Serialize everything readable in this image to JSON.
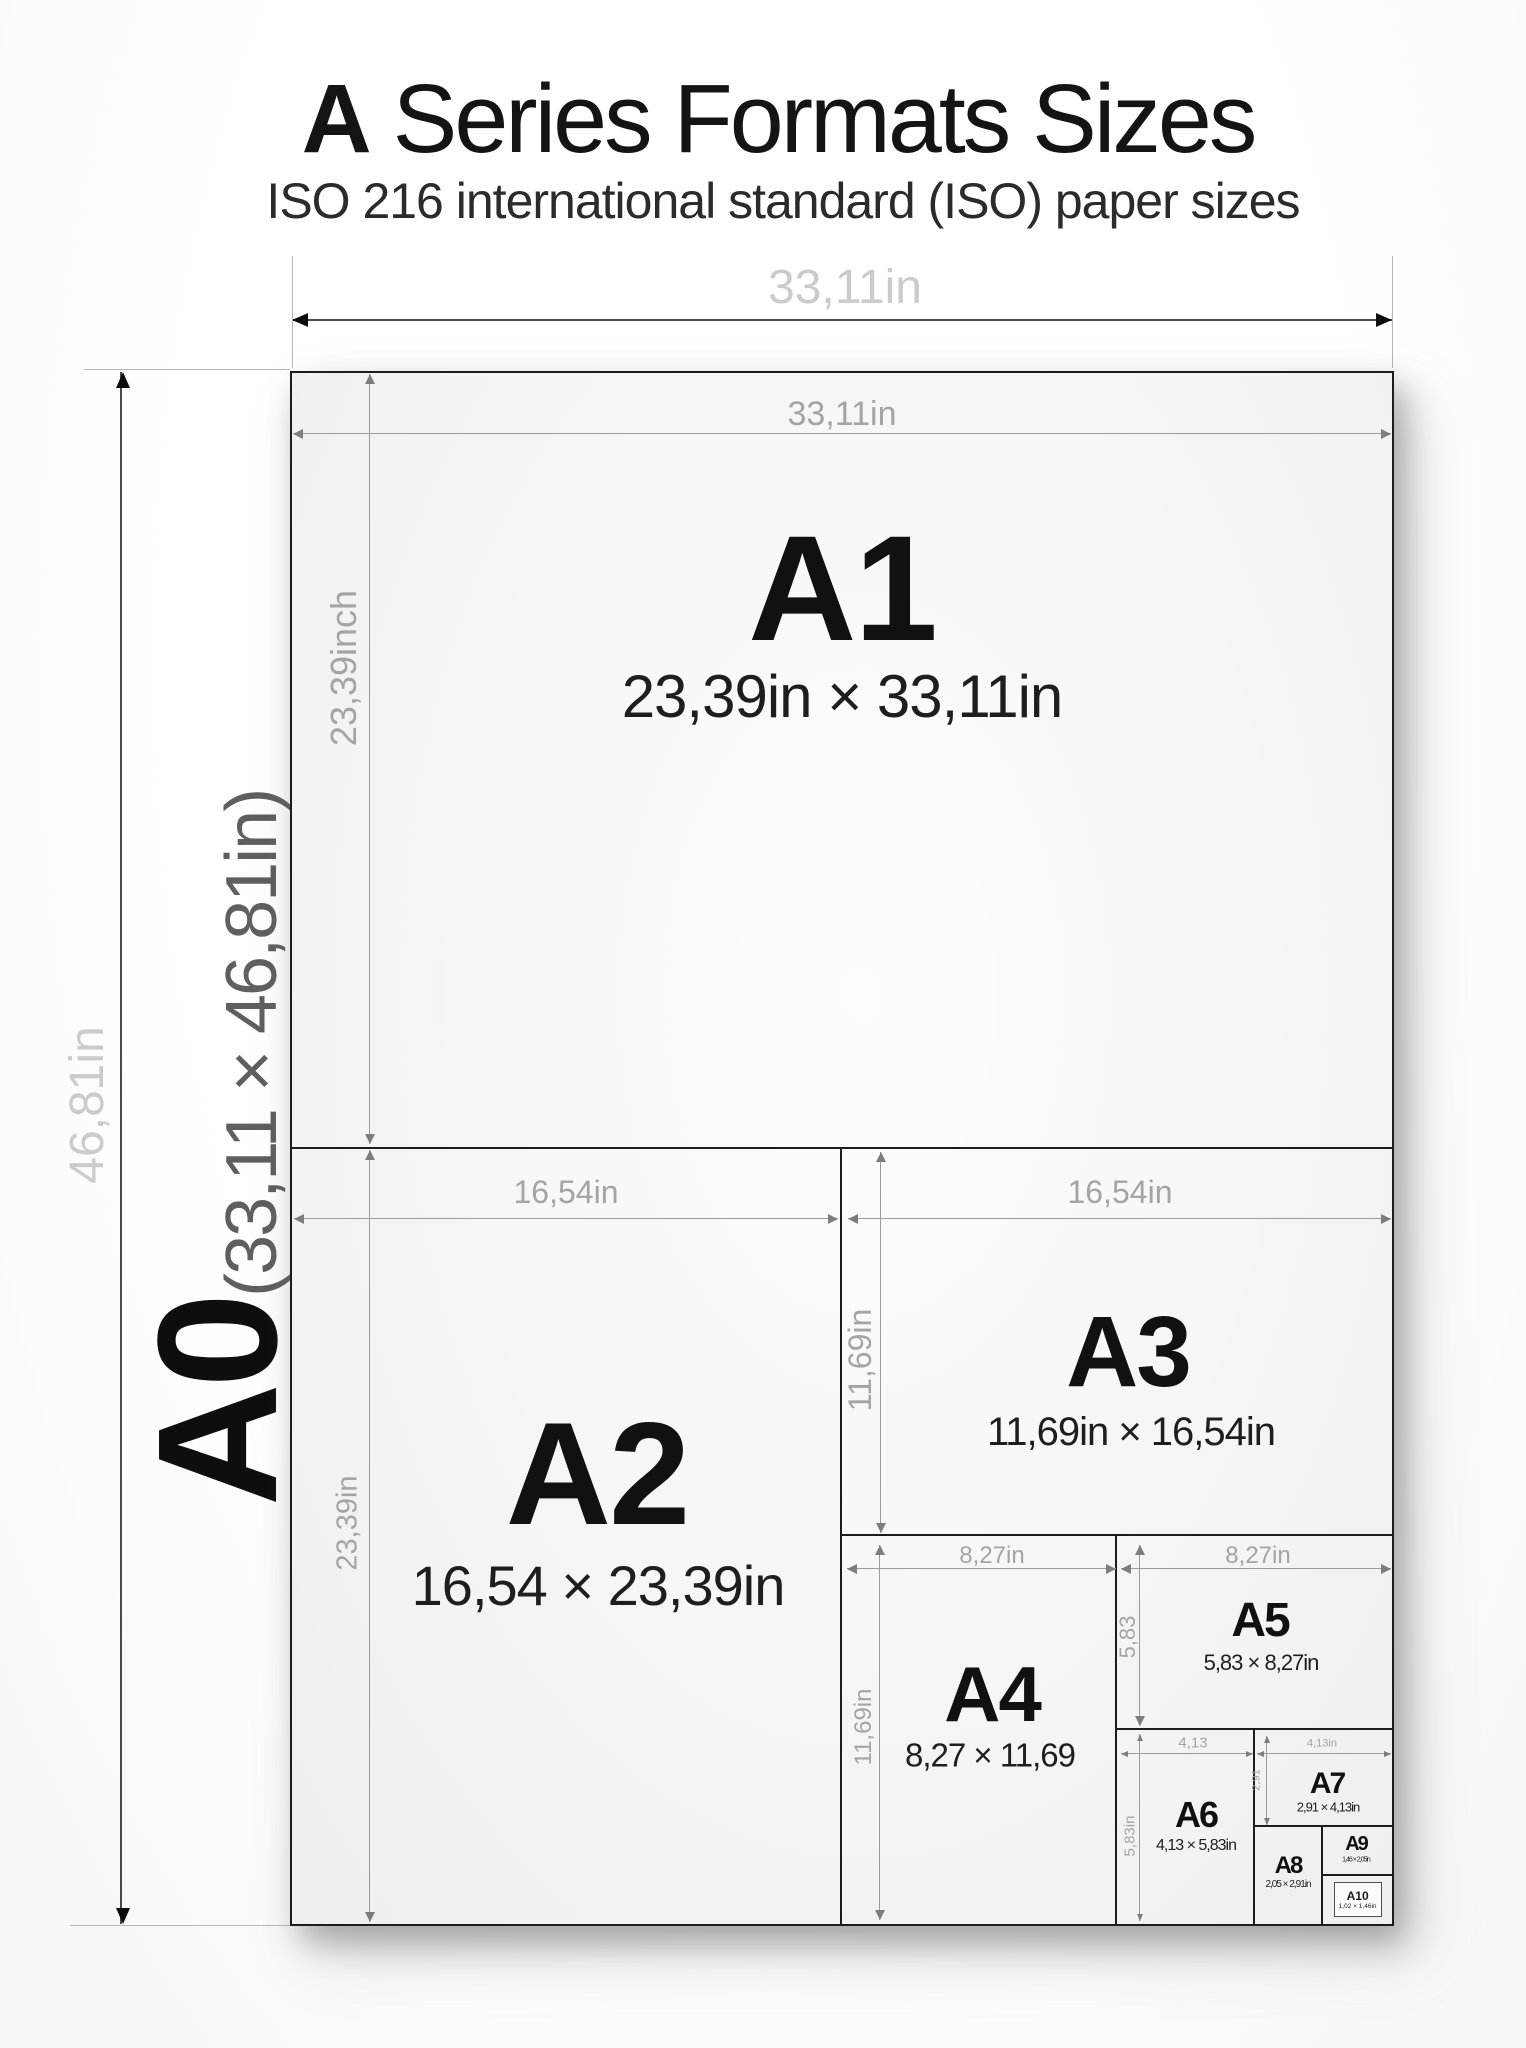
{
  "header": {
    "title_bold": "A",
    "title_rest": " Series Formats Sizes",
    "subtitle": "ISO 216 international standard (ISO) paper sizes"
  },
  "outer_dims": {
    "width_label": "33,11in",
    "height_label": "46,81in",
    "sheet_name": "A0",
    "sheet_dims": "(33,11 × 46,81in)"
  },
  "formats": {
    "a1": {
      "name": "A1",
      "dims": "23,39in × 33,11in",
      "width_label": "33,11in",
      "height_label": "23,39inch"
    },
    "a2": {
      "name": "A2",
      "dims": "16,54 × 23,39in",
      "width_label": "16,54in",
      "height_label": "23,39in"
    },
    "a3": {
      "name": "A3",
      "dims": "11,69in × 16,54in",
      "width_label": "16,54in",
      "height_label": "11,69in"
    },
    "a4": {
      "name": "A4",
      "dims": "8,27 × 11,69",
      "width_label": "8,27in",
      "height_label": "11,69in"
    },
    "a5": {
      "name": "A5",
      "dims": "5,83 × 8,27in",
      "width_label": "8,27in",
      "height_label": "5,83"
    },
    "a6": {
      "name": "A6",
      "dims": "4,13 × 5,83in",
      "width_label": "4,13",
      "height_label": "5,83in"
    },
    "a7": {
      "name": "A7",
      "dims": "2,91 × 4,13in",
      "width_label": "4,13in",
      "height_label": "2,91"
    },
    "a8": {
      "name": "A8",
      "dims": "2,05 × 2,91in"
    },
    "a9": {
      "name": "A9",
      "dims": "1,46 × 2,05in"
    },
    "a10": {
      "name": "A10",
      "dims": "1,02 × 1,46in"
    }
  },
  "colors": {
    "sheet_border": "#1c1c1c",
    "dim_line": "#9b9b9b",
    "dim_label": "#a4a4a4",
    "light_label": "#cbcbcb",
    "text": "#1a1a1a"
  }
}
